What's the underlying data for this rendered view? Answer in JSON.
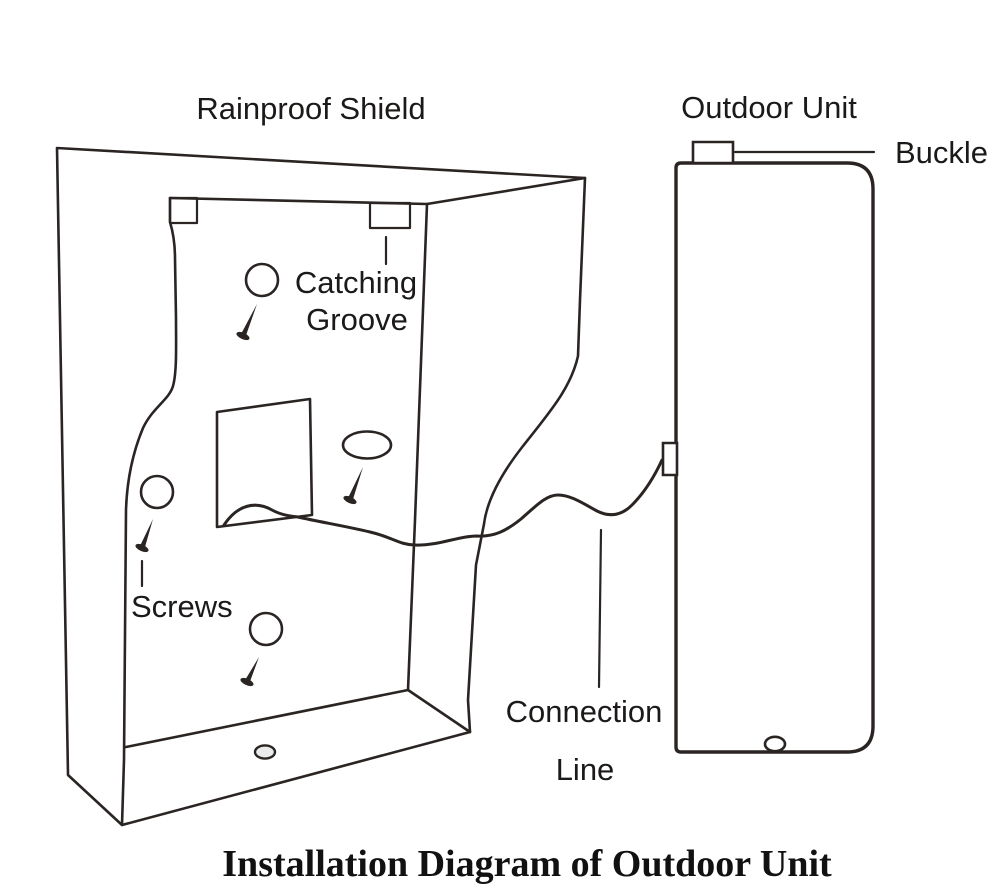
{
  "title": "Installation Diagram of Outdoor Unit",
  "labels": {
    "rainproof_shield": "Rainproof Shield",
    "outdoor_unit": "Outdoor Unit",
    "buckle": "Buckle",
    "catching_groove_line1": "Catching",
    "catching_groove_line2": "Groove",
    "screws": "Screws",
    "connection_line_line1": "Connection",
    "connection_line_line2": "Line"
  },
  "colors": {
    "line": "#2a2523",
    "text": "#1c1a19",
    "outdoor_unit_fill": "#b5b5b5",
    "floor_hole_fill": "#ebebeb",
    "background": "#ffffff"
  }
}
